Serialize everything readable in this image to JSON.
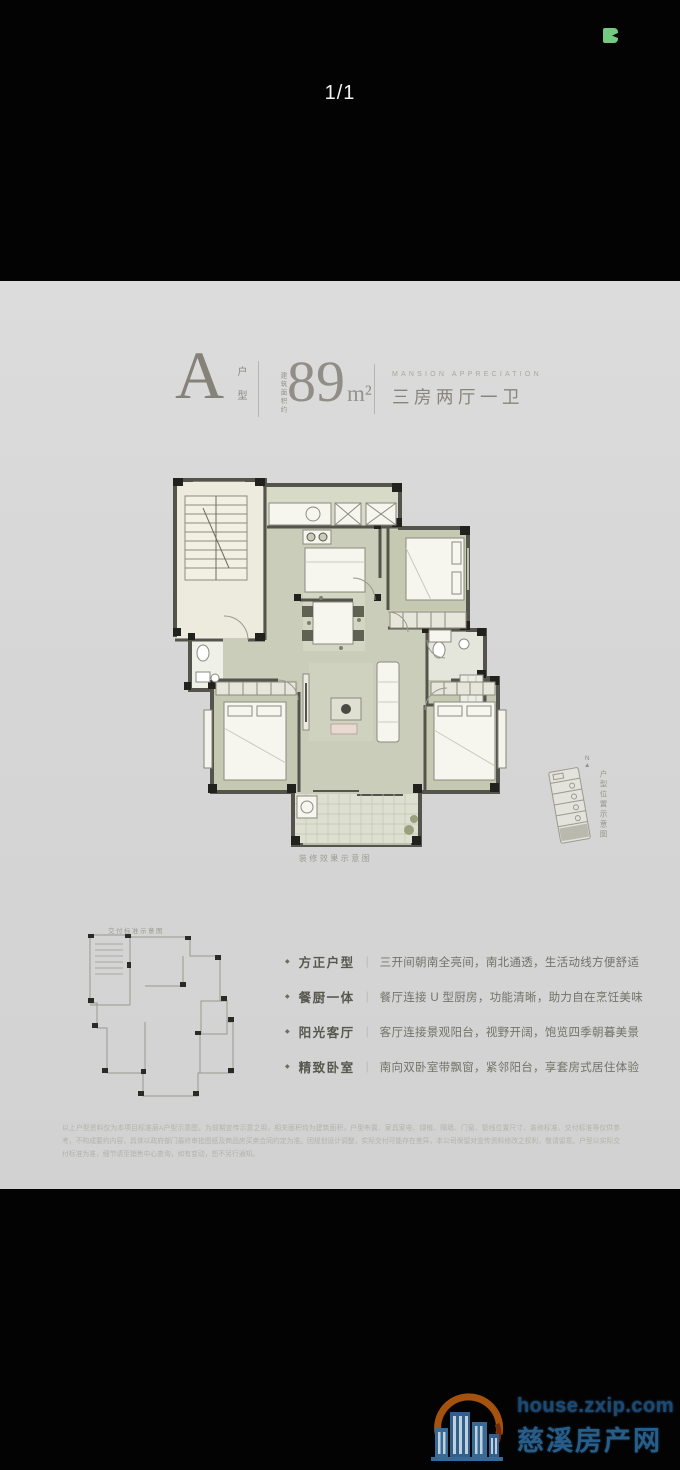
{
  "pager": {
    "label": "1/1"
  },
  "page": {
    "header": {
      "unit_letter": "A",
      "unit_type_vertical": "户型",
      "area_prefix_vertical": "建筑面积约",
      "area_value": "89",
      "area_unit": "m²",
      "en_subtitle": "MANSION APPRECIATION",
      "layout_text": "三房两厅一卫"
    },
    "plan_caption": "装修效果示意图",
    "north_label": "N",
    "location_caption_vertical": "户型位置示意图",
    "delivery_caption": "交付标准示意图",
    "features_marker": "◆",
    "features_separator": "｜",
    "features": [
      {
        "label": "方正户型",
        "desc": "三开间朝南全亮间，南北通透，生活动线方便舒适"
      },
      {
        "label": "餐厨一体",
        "desc": "餐厅连接 U 型厨房，功能清晰，助力自在烹饪美味"
      },
      {
        "label": "阳光客厅",
        "desc": "客厅连接景观阳台，视野开阔，饱览四季朝暮美景"
      },
      {
        "label": "精致卧室",
        "desc": "南向双卧室带飘窗，紧邻阳台，享套房式居住体验"
      }
    ],
    "disclaimer": "以上户型资料仅为本项目标准层A户型示意图，为前期宣传示意之用，相关面积均为建筑面积，户型布置、家具家电、绿植、隔墙、门窗、管线位置尺寸、装修标准、交付标准等仅供参考，不构成要约内容，具体以政府部门最终审批图纸及商品房买卖合同约定为准。因规划设计调整，实际交付可能存在差异，本公司保留对宣传资料修改之权利，敬请留意。户型以实际交付标准为准，细节请至销售中心查询，如有变动，恕不另行通知。"
  },
  "watermark": {
    "url": "house.zxip.com",
    "site_name": "慈溪房产网"
  },
  "colors": {
    "page_background": "#d6d6d6",
    "wall": "#54544c",
    "pillar": "#21211d",
    "room_floor": "#cacdb9",
    "stair_floor": "#edebdd",
    "accent_green_icon": "#74ca80",
    "watermark_blue": "#2b6595",
    "watermark_orange": "#b2590f"
  }
}
